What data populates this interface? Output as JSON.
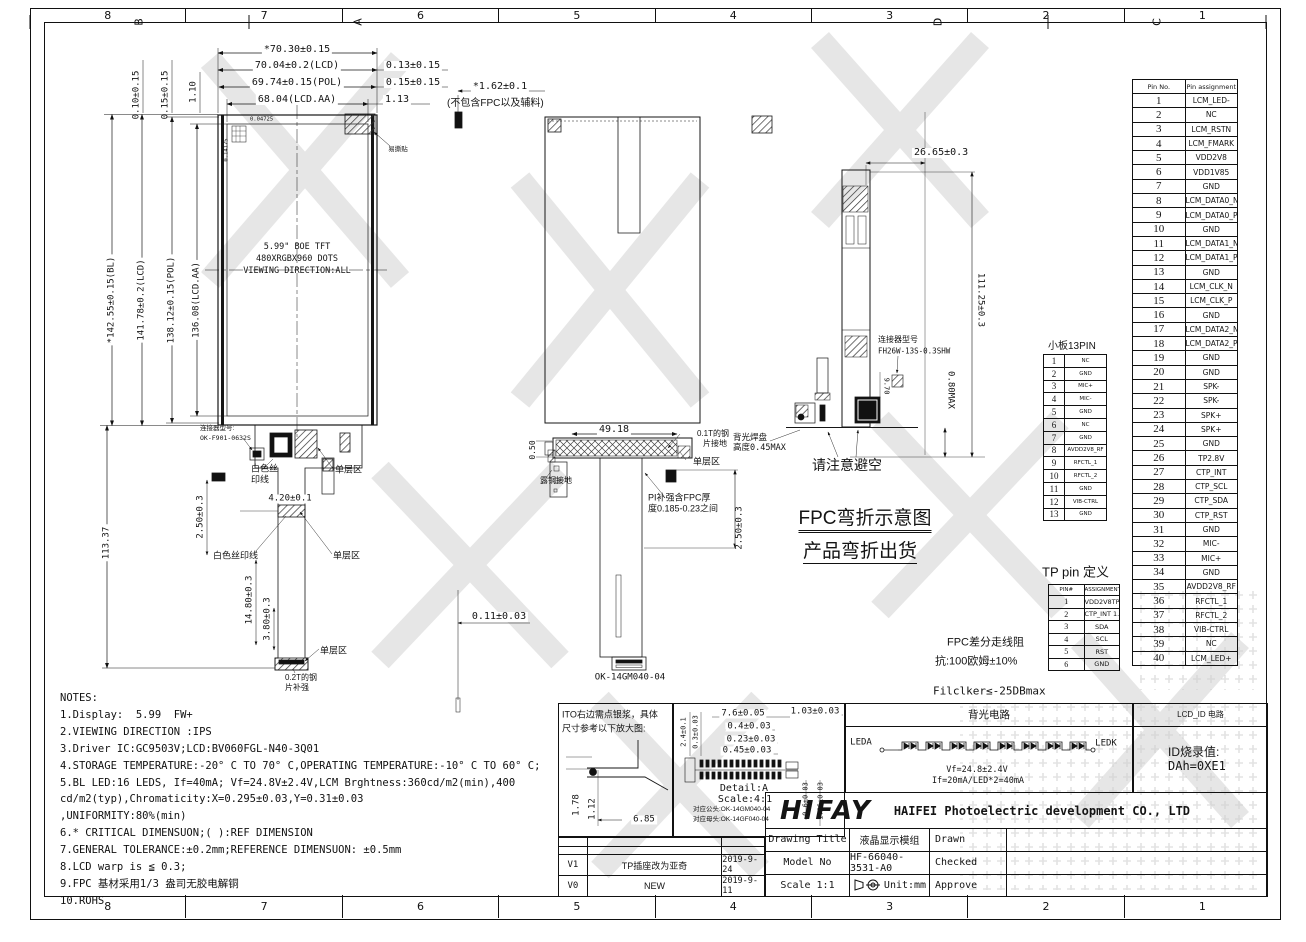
{
  "sheet": {
    "watermark_text": "海飞"
  },
  "zones": {
    "top": [
      "8",
      "7",
      "6",
      "5",
      "4",
      "3",
      "2",
      "1"
    ],
    "side": [
      "D",
      "C",
      "B",
      "A"
    ]
  },
  "front_view": {
    "dim_w_total": "*70.30±0.15",
    "dim_w_lcd": "70.04±0.2(LCD)",
    "dim_w_pol": "69.74±0.15(POL)",
    "dim_w_aa": "68.04(LCD.AA)",
    "dim_gap1": "0.13±0.15",
    "dim_gap2": "0.15±0.15",
    "dim_gap3": "1.13",
    "dim_off1": "0.10±0.15",
    "dim_off2": "0.15±0.15",
    "dim_off3": "1.10",
    "dim_h_bl": "*142.55±0.15(BL)",
    "dim_h_lcd": "141.78±0.2(LCD)",
    "dim_h_pol": "138.12±0.15(POL)",
    "dim_h_aa": "136.08(LCD.AA)",
    "dim_h_fpc": "113.37",
    "panel_line1": "5.99\" BOE  TFT",
    "panel_line2": "480XRGBX960 DOTS",
    "panel_line3": "VIEWING DIRECTION:ALL",
    "pixel_pitch_h": "0.04725",
    "pixel_pitch_v": "0.14175",
    "tear_sticker": "易撕贴",
    "connector_label_1": "连接器型号:",
    "connector_label_2": "OK-F901-0632S",
    "white_silk_1a": "白色丝",
    "white_silk_1b": "印线",
    "white_silk_2": "白色丝印线",
    "single_layer_1": "单层区",
    "single_layer_2": "单层区",
    "single_layer_3": "单层区",
    "dim_silk": "2.50±0.3",
    "dim_band": "4.20±0.1",
    "dim_tail1": "14.80±0.3",
    "dim_tail2": "3.80±0.3",
    "steel_1": "0.2T的钢",
    "steel_2": "片补强"
  },
  "section_view": {
    "dim_thickness": "*1.62±0.1",
    "thickness_note": "(不包含FPC以及辅料)",
    "dim_width": "49.18",
    "dim_left": "0.50",
    "steel_gnd_1": "0.1T的钢",
    "steel_gnd_2": "片接地",
    "single_layer": "单层区",
    "copper_gnd": "露铜接地",
    "pi_note_1": "PI补强含FPC厚",
    "pi_note_2": "度0.185-0.23之间",
    "dim_right": "2.50±0.3",
    "dim_bottom": "0.11±0.03",
    "connector": "OK-14GM040-04"
  },
  "side_view": {
    "dim_top": "26.65±0.3",
    "dim_height": "111.25±0.3",
    "dim_max": "0.80MAX",
    "dim_conn": "9.70",
    "connector_label_1": "连接器型号",
    "connector_label_2": "FH26W-13S-0.3SHW",
    "bl_pad_1": "背光焊盘",
    "bl_pad_2": "高度0.45MAX",
    "avoid_note": "请注意避空",
    "bend_title_1": "FPC弯折示意图",
    "bend_title_2": "产品弯折出货",
    "impedance_1": "FPC差分走线阻",
    "impedance_2": "抗:100欧姆±10%",
    "flicker_note": "Filclker≤-25DBmax"
  },
  "pin_table": {
    "header_no": "Pin No.",
    "header_assign": "Pin assignment",
    "rows": [
      {
        "no": "1",
        "name": "LCM_LED-"
      },
      {
        "no": "2",
        "name": "NC"
      },
      {
        "no": "3",
        "name": "LCM_RSTN"
      },
      {
        "no": "4",
        "name": "LCM_FMARK"
      },
      {
        "no": "5",
        "name": "VDD2V8"
      },
      {
        "no": "6",
        "name": "VDD1V85"
      },
      {
        "no": "7",
        "name": "GND"
      },
      {
        "no": "8",
        "name": "LCM_DATA0_N"
      },
      {
        "no": "9",
        "name": "LCM_DATA0_P"
      },
      {
        "no": "10",
        "name": "GND"
      },
      {
        "no": "11",
        "name": "LCM_DATA1_N"
      },
      {
        "no": "12",
        "name": "LCM_DATA1_P"
      },
      {
        "no": "13",
        "name": "GND"
      },
      {
        "no": "14",
        "name": "LCM_CLK_N"
      },
      {
        "no": "15",
        "name": "LCM_CLK_P"
      },
      {
        "no": "16",
        "name": "GND"
      },
      {
        "no": "17",
        "name": "LCM_DATA2_N"
      },
      {
        "no": "18",
        "name": "LCM_DATA2_P"
      },
      {
        "no": "19",
        "name": "GND"
      },
      {
        "no": "20",
        "name": "GND"
      },
      {
        "no": "21",
        "name": "SPK-"
      },
      {
        "no": "22",
        "name": "SPK-"
      },
      {
        "no": "23",
        "name": "SPK+"
      },
      {
        "no": "24",
        "name": "SPK+"
      },
      {
        "no": "25",
        "name": "GND"
      },
      {
        "no": "26",
        "name": "TP2.8V"
      },
      {
        "no": "27",
        "name": "CTP_INT"
      },
      {
        "no": "28",
        "name": "CTP_SCL"
      },
      {
        "no": "29",
        "name": "CTP_SDA"
      },
      {
        "no": "30",
        "name": "CTP_RST"
      },
      {
        "no": "31",
        "name": "GND"
      },
      {
        "no": "32",
        "name": "MIC-"
      },
      {
        "no": "33",
        "name": "MIC+"
      },
      {
        "no": "34",
        "name": "GND"
      },
      {
        "no": "35",
        "name": "AVDD2V8_RF"
      },
      {
        "no": "36",
        "name": "RFCTL_1"
      },
      {
        "no": "37",
        "name": "RFCTL_2"
      },
      {
        "no": "38",
        "name": "VIB-CTRL"
      },
      {
        "no": "39",
        "name": "NC"
      },
      {
        "no": "40",
        "name": "LCM_LED+"
      }
    ]
  },
  "small_board": {
    "title": "小板13PIN",
    "rows": [
      {
        "no": "1",
        "name": "NC"
      },
      {
        "no": "2",
        "name": "GND"
      },
      {
        "no": "3",
        "name": "MIC+"
      },
      {
        "no": "4",
        "name": "MIC-"
      },
      {
        "no": "5",
        "name": "GND"
      },
      {
        "no": "6",
        "name": "NC"
      },
      {
        "no": "7",
        "name": "GND"
      },
      {
        "no": "8",
        "name": "AVDD2V8_RF"
      },
      {
        "no": "9",
        "name": "RFCTL_1"
      },
      {
        "no": "10",
        "name": "RFCTL_2"
      },
      {
        "no": "11",
        "name": "GND"
      },
      {
        "no": "12",
        "name": "VIB-CTRL"
      },
      {
        "no": "13",
        "name": "GND"
      }
    ]
  },
  "tp_table": {
    "title": "TP pin 定义",
    "header_no": "PIN#",
    "header_assign": "ASSIGNMENT",
    "rows": [
      {
        "no": "1",
        "name": "VDD2V8TP"
      },
      {
        "no": "2",
        "name": "CTP_INT 1.8V"
      },
      {
        "no": "3",
        "name": "SDA"
      },
      {
        "no": "4",
        "name": "SCL"
      },
      {
        "no": "5",
        "name": "RST"
      },
      {
        "no": "6",
        "name": "GND"
      }
    ]
  },
  "ito_panel": {
    "note_1": "ITO右边需点银浆，具体",
    "note_2": "尺寸参考以下放大图:",
    "dim_1": "1.78",
    "dim_2": "1.12",
    "dim_3": "6.85"
  },
  "detail_panel": {
    "dim_1": "7.6±0.05",
    "dim_2": "0.4±0.03",
    "dim_3": "0.23±0.03",
    "dim_4": "0.45±0.03",
    "dim_5": "1.03±0.03",
    "dim_v1": "2.4±0.1",
    "dim_v2": "0.3±0.03",
    "dim_v3": "0.6±0.03",
    "dim_v4": "1.66±0.03",
    "title": "Detail:A",
    "scale": "Scale:4:1",
    "male_note": "对应公头:OK-14GM040-04",
    "female_note": "对应母头:OK-14GF040-04"
  },
  "backlight_panel": {
    "title": "背光电路",
    "anode": "LEDA",
    "cathode": "LEDK",
    "vf": "Vf=24.8±2.4V",
    "if": "If=20mA/LED*2=40mA"
  },
  "lcd_id_panel": {
    "title": "LCD_ID 电路",
    "line_1": "ID烧录值:",
    "line_2": "DAh=0XE1"
  },
  "notes": {
    "title": "NOTES:",
    "lines": [
      "1.Display:  5.99  FW+",
      "2.VIEWING DIRECTION :IPS",
      "3.Driver IC:GC9503V;LCD:BV060FGL-N40-3Q01",
      "4.STORAGE TEMPERATURE:-20° C TO 70° C,OPERATING TEMPERATURE:-10° C TO 60° C;",
      "5.BL LED:16 LEDS, If=40mA; Vf=24.8V±2.4V,LCM Brghtness:360cd/m2(min),400",
      "cd/m2(typ),Chromaticity:X=0.295±0.03,Y=0.31±0.03",
      ",UNIFORMITY:80%(min)",
      "6.* CRITICAL DIMENSUON;( ):REF DIMENSION",
      "7.GENERAL TOLERANCE:±0.2mm;REFERENCE DIMENSUON: ±0.5mm",
      "8.LCD warp is ≦ 0.3;",
      "9.FPC 基材采用1/3 盎司无胶电解铜",
      "10.ROHS"
    ]
  },
  "title_block": {
    "logo": "HIFAY",
    "company": "HAIFEI Photoelectric development CO., LTD",
    "drawing_title_label": "Drawing Title",
    "drawing_title_value": "液晶显示模组",
    "drawn_label": "Drawn",
    "model_label": "Model No",
    "model_value": "HF-66040-3531-A0",
    "checked_label": "Checked",
    "scale_label": "Scale 1:1",
    "unit_label": "Unit:mm",
    "approve_label": "Approve"
  },
  "revisions": [
    {
      "rev": "V1",
      "desc": "TP插座改为亚奇",
      "date": "2019-9-24"
    },
    {
      "rev": "V0",
      "desc": "NEW",
      "date": "2019-9-11"
    }
  ]
}
